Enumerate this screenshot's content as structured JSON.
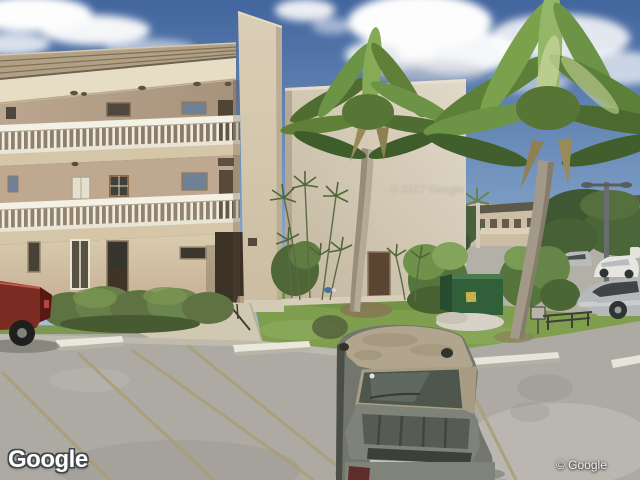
{
  "image_type": "street-view-photograph",
  "attribution": {
    "logo_text": "Google",
    "copyright_text": "© Google",
    "watermark_text": "© 2017 Google"
  },
  "colors": {
    "sky_top": "#41659f",
    "sky_horizon": "#b9cbdb",
    "cloud": "#ffffff",
    "roof_shingle": "#b3a184",
    "building_wall": "#cfc0a6",
    "end_wall": "#ddd3c0",
    "soffit": "#e9dfc6",
    "railing_white": "#f2efe4",
    "grass": "#7fa04e",
    "hedge_green": "#5d7340",
    "palm_green": "#6d9346",
    "asphalt": "#adaba4",
    "parking_line_tan": "#ac9f74",
    "curb_white": "#ece9dd",
    "van_roof": "#b2a78d",
    "van_body": "#7e8278",
    "dumpster_green": "#2f5e38",
    "truck_red": "#7d2a22"
  },
  "scene": {
    "description": "Street-level photo of a three-story tan apartment building with white balcony railings, a blank end wall, palm trees, hedges, a green dumpster, and a parking lot with a gray van, a red pickup truck and distant parked cars under a blue sky with clouds.",
    "objects": [
      "sky",
      "clouds",
      "apartment-building",
      "balcony-railings",
      "entrance-breezeway",
      "end-wall",
      "palm-trees",
      "hedges",
      "lawn",
      "dumpster",
      "parking-lot",
      "parking-lines",
      "parking-curbs",
      "gray-van",
      "red-pickup-truck",
      "distant-building",
      "distant-cars",
      "street-light",
      "walkway"
    ]
  }
}
